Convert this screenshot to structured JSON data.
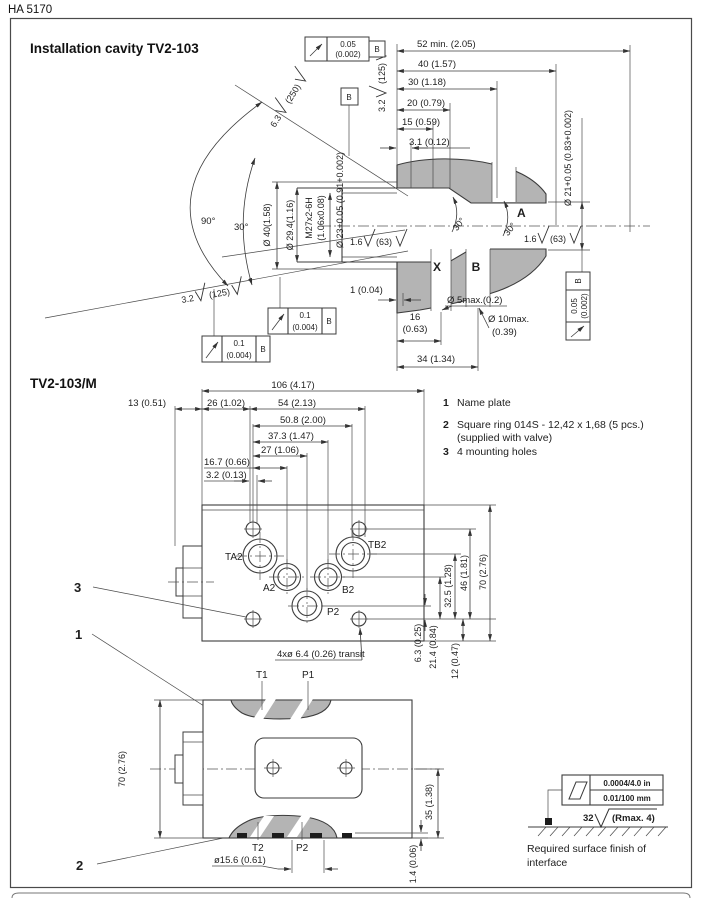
{
  "page": {
    "header": "HA 5170"
  },
  "cavity": {
    "title": "Installation cavity TV2-103",
    "dims": {
      "d52": "52 min. (2.05)",
      "d40": "40 (1.57)",
      "d30": "30 (1.18)",
      "d20": "20 (0.79)",
      "d15": "15 (0.59)",
      "d3_1": "3.1 (0.12)",
      "d1": "1 (0.04)",
      "d16": "16",
      "d16_in": "(0.63)",
      "d34": "34 (1.34)",
      "dia5": "Ø 5max.(0.2)",
      "dia10": "Ø 10max.",
      "dia10_in": "(0.39)",
      "dia21": "Ø 21+0.05 (0.83+0.002)",
      "dia23": "Ø 23+0.05 (0.91+0.002)",
      "dia29": "Ø 29.4(1.16)",
      "dia40": "Ø 40(1.58)",
      "thread": "M27x2-6H",
      "thread_in": "(1.06x0.08)"
    },
    "angles": {
      "a90": "90°",
      "a30": "30°",
      "ch30": "30°"
    },
    "ports": {
      "a": "A",
      "x": "X",
      "b": "B"
    },
    "datum": "B",
    "fcf": {
      "runout_tol": "0.05",
      "runout_tol_in": "(0.002)",
      "pos_tol": "0.1",
      "pos_tol_in": "(0.004)",
      "datum": "B"
    },
    "finish": {
      "f63": "6.3",
      "f63_alt": "(250)",
      "f32": "3.2",
      "f32_alt": "(125)",
      "f16": "1.6",
      "f16_alt": "(63)"
    }
  },
  "valve": {
    "title": "TV2-103/M",
    "legend": {
      "i1_num": "1",
      "i1_text": "Name plate",
      "i2_num": "2",
      "i2_text": "Square ring 014S - 12,42 x 1,68 (5 pcs.)",
      "i2_text2": "(supplied with valve)",
      "i3_num": "3",
      "i3_text": "4 mounting holes"
    },
    "callouts": {
      "c1": "1",
      "c2": "2",
      "c3": "3"
    },
    "top": {
      "dims": {
        "d106": "106 (4.17)",
        "d13": "13 (0.51)",
        "d26": "26 (1.02)",
        "d54": "54 (2.13)",
        "d50_8": "50.8 (2.00)",
        "d37_3": "37.3 (1.47)",
        "d27": "27 (1.06)",
        "d16_7": "16.7 (0.66)",
        "d3_2": "3.2 (0.13)",
        "d70": "70 (2.76)",
        "d46": "46 (1.81)",
        "d32_5": "32.5 (1.28)",
        "d21_4": "21.4 (0.84)",
        "d6_3": "6.3 (0.25)",
        "d12": "12 (0.47)"
      },
      "ports": {
        "ta2": "TA2",
        "tb2": "TB2",
        "a2": "A2",
        "b2": "B2",
        "p2": "P2"
      },
      "note_transit": "4xø 6.4 (0.26) transit"
    },
    "front": {
      "ports": {
        "t1": "T1",
        "p1": "P1",
        "t2": "T2",
        "p2": "P2"
      },
      "dims": {
        "d70": "70 (2.76)",
        "d35": "35 (1.38)",
        "dia15_6": "ø15.6 (0.61)",
        "d1_4": "1.4 (0.06)"
      }
    }
  },
  "finish_req": {
    "flat_in": "0.0004/4.0 in",
    "flat_mm": "0.01/100 mm",
    "rough": "32",
    "rough_note": "(Rmax. 4)",
    "caption1": "Required surface finish of",
    "caption2": "interface"
  }
}
